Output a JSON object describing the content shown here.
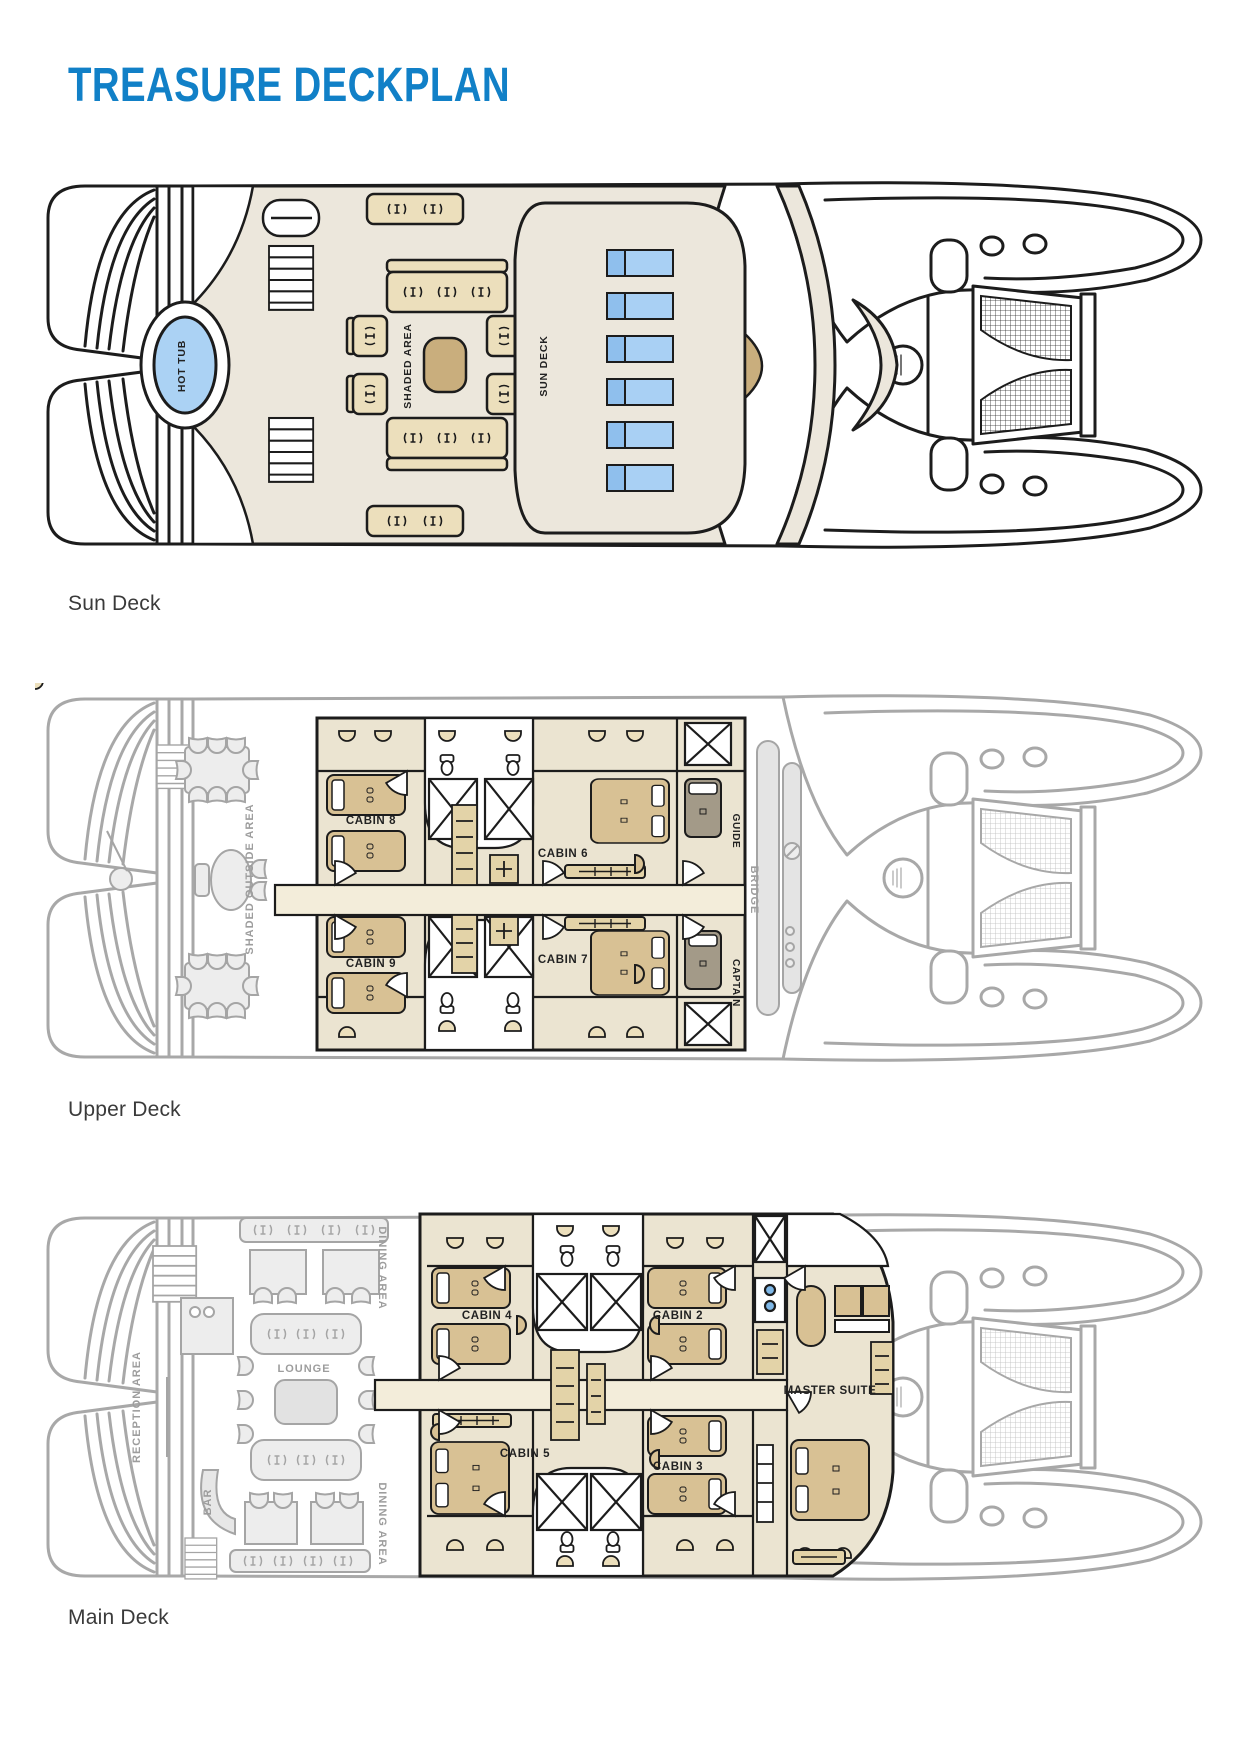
{
  "title": "TREASURE DECKPLAN",
  "colors": {
    "accent_blue": "#1180c7",
    "deck_beige": "#ece7dc",
    "furniture_tan": "#ecdfbc",
    "table_tan": "#c9ae7d",
    "lounger_blue": "#a9d0f4",
    "lounger_blue_dark": "#8fbfed",
    "hot_tub_blue": "#abd2f4",
    "bed_tan": "#d8c194",
    "crew_bed_gray": "#a39a88",
    "ghost_gray": "#a8a8a8",
    "ink": "#1c1c1c"
  },
  "decks": {
    "sun": {
      "caption": "Sun Deck",
      "labels": {
        "hot_tub": "HOT TUB",
        "shaded_area": "SHADED AREA",
        "sun_deck": "SUN DECK"
      }
    },
    "upper": {
      "caption": "Upper Deck",
      "labels": {
        "shaded_outside_area": "SHADED OUTSIDE AREA",
        "cabin8": "CABIN 8",
        "cabin9": "CABIN 9",
        "cabin6": "CABIN 6",
        "cabin7": "CABIN 7",
        "guide": "GUIDE",
        "captain": "CAPTAIN",
        "bridge": "BRIDGE"
      }
    },
    "main": {
      "caption": "Main Deck",
      "labels": {
        "reception_area": "RECEPTION AREA",
        "dining_area_top": "DINING AREA",
        "dining_area_bottom": "DINING AREA",
        "lounge": "LOUNGE",
        "bar": "BAR",
        "cabin4": "CABIN 4",
        "cabin5": "CABIN 5",
        "cabin2": "CABIN 2",
        "cabin3": "CABIN 3",
        "master_suite": "MASTER SUITE"
      }
    }
  }
}
